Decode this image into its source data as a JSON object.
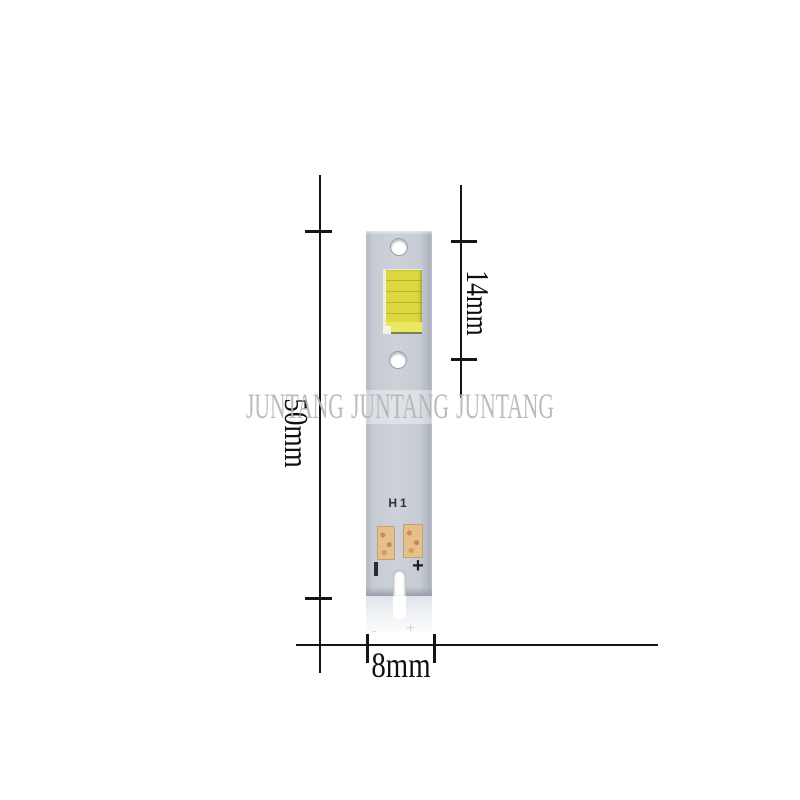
{
  "watermark": {
    "text": "JUNTANG JUNTANG JUNTANG"
  },
  "pcb": {
    "model": "H1",
    "positive_mark": "+",
    "negative_mark": "|",
    "holes": 2,
    "led_chip": "yellow COB phosphor chip"
  },
  "dimensions": {
    "height": "50mm",
    "led_span": "14mm",
    "width": "8mm"
  },
  "reflection": {
    "negative_mark": "-",
    "positive_mark": "+"
  },
  "colors": {
    "pcb_body": "#cdd1d8",
    "chip_yellow": "#dcd83f",
    "chip_yellow_light": "#ebe765",
    "pad_copper": "#e5c08f",
    "pad_spot": "#cf8a45",
    "watermark_gray": "#b4b4b4",
    "dimension_line": "#151515"
  }
}
